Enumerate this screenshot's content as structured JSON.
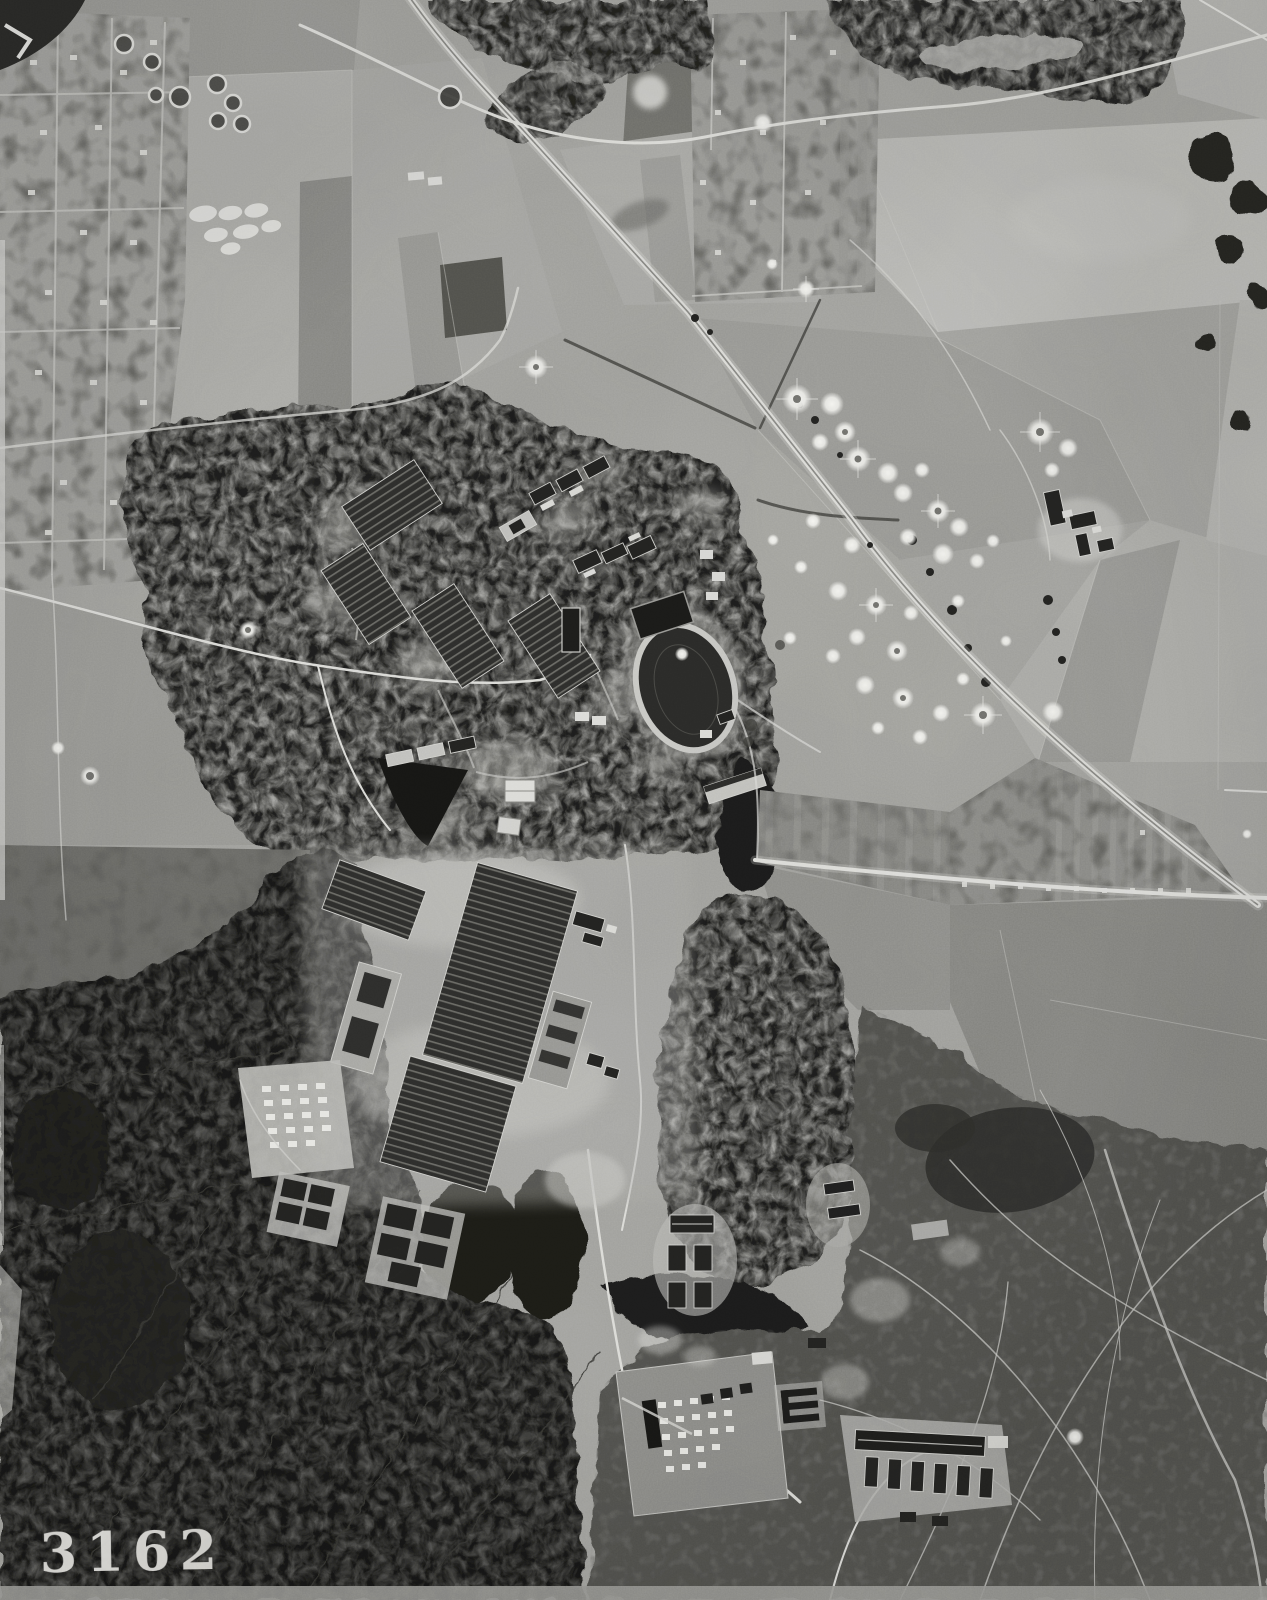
{
  "photo": {
    "id_stamp": "3162",
    "kind": "black-and-white vertical aerial reconnaissance photograph",
    "palette": {
      "field_light": "#b3b3af",
      "field_mid": "#9e9e9a",
      "field_pale": "#c2c2be",
      "forest_dark": "#20201e",
      "plantation_dark": "#141412",
      "heath_gray": "#53534f",
      "road_white": "#e3e3df",
      "crater_white": "#f5f5f1",
      "building_dark": "#242422",
      "stamp_white": "#ecebe7"
    },
    "features": [
      "suburban settlement north-west",
      "anti-aircraft ring emplacements",
      "autobahn and railway diagonal",
      "farm fields with crop rows",
      "bomb crater field",
      "military camp in forest",
      "sports stadium with running track",
      "factory halls with sawtooth roofs",
      "storage yard with crate rows",
      "barracks clusters",
      "supply depot compound",
      "heathland criss-crossed by tracks",
      "village allotments east",
      "dark forest plantation south-west"
    ]
  }
}
